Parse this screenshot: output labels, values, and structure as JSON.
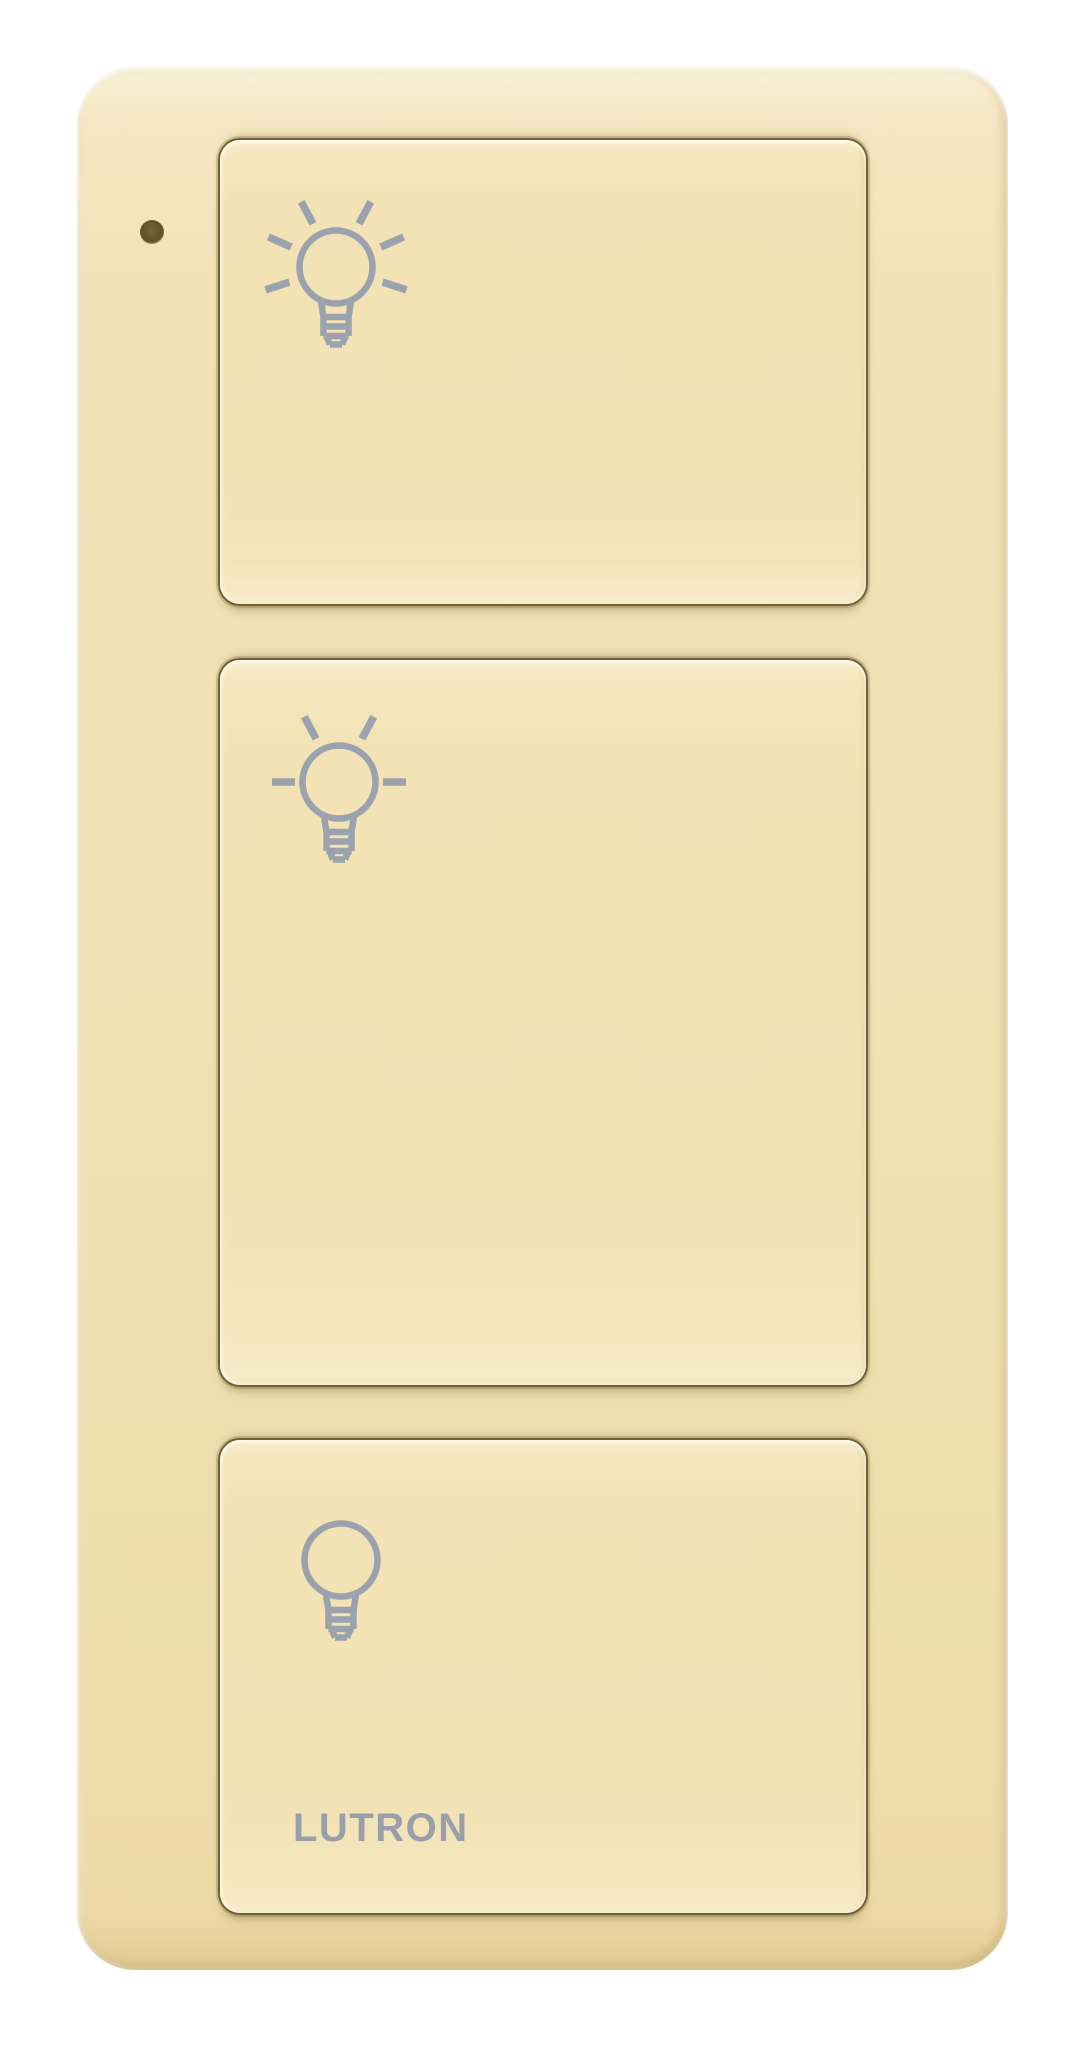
{
  "colors": {
    "background": "#ffffff",
    "body": "#f0e0b2",
    "button": "#f1e1b3",
    "crease": "#695a31",
    "icon": "#9aa2ad",
    "logo": "#99a0a9",
    "led": "#665828"
  },
  "device": {
    "brand_label": "LUTRON",
    "led": {
      "name": "status-led",
      "state": "off"
    },
    "buttons": [
      {
        "name": "light-on",
        "icon": "light-on-icon",
        "glyph": "bulb with six rays"
      },
      {
        "name": "favorite-preset",
        "icon": "favorite-preset-icon",
        "glyph": "bulb with two rays and side dashes"
      },
      {
        "name": "light-off",
        "icon": "light-off-icon",
        "glyph": "plain bulb"
      }
    ]
  }
}
